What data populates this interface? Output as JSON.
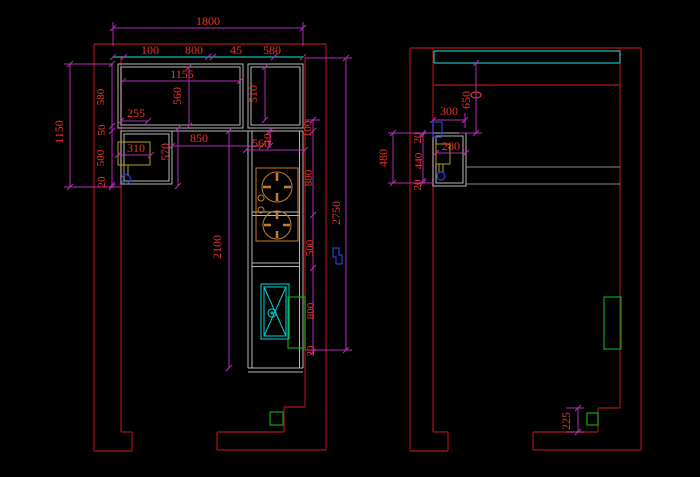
{
  "colors": {
    "background": "#000000",
    "wall": "#8e1212",
    "dimension": "#b52cb5",
    "dimension_text": "#f03428",
    "cabinet": "#b9b9b9",
    "cabinet_dark": "#8a8a8a",
    "cyan": "#1cb8b8",
    "sink": "#00d4d4",
    "stove": "#c87e28",
    "meter": "#b4a21c",
    "green": "#12a312",
    "blue": "#2b3fd8",
    "valve_fill": "#0a1030",
    "accent_red": "#ff4646"
  },
  "left_view": {
    "d1800": "1800",
    "row": [
      "100",
      "800",
      "45",
      "580"
    ],
    "d1155": "1155",
    "d560_upper": "560",
    "d510": "510",
    "d255": "255",
    "d1150": "1150",
    "stack": [
      "580",
      "50",
      "500",
      "20"
    ],
    "d310": "310",
    "d570": "570",
    "d850": "850",
    "d560_counter": "560",
    "d10": "10",
    "d2100": "2100",
    "right_stack": [
      "100",
      "800",
      "500",
      "800",
      "20"
    ],
    "d2750": "2750"
  },
  "right_view": {
    "d650": "650",
    "d300": "300",
    "d280": "280",
    "left_stack": [
      "20",
      "440",
      "20"
    ],
    "d480": "480",
    "d225": "225"
  }
}
